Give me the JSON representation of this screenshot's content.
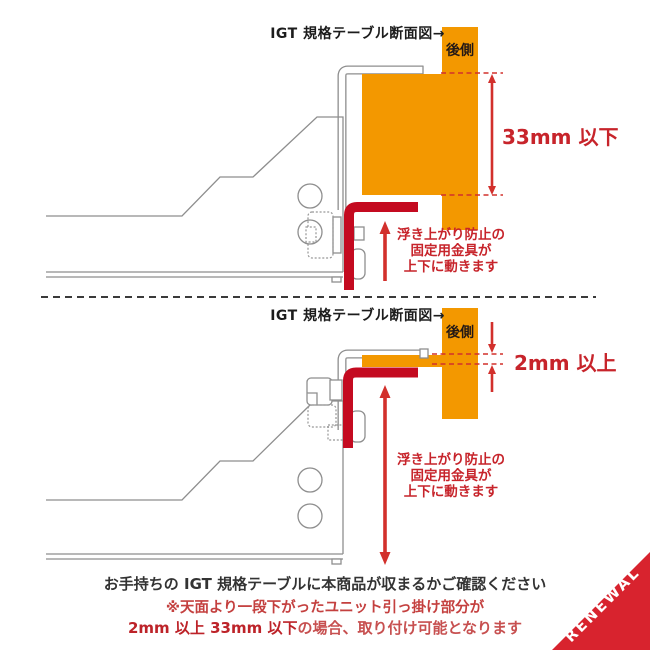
{
  "top_diagram": {
    "label": "IGT 規格テーブル断面図→",
    "rear_label": "後側",
    "dimension": "33mm 以下",
    "note_lines": [
      "浮き上がり防止の",
      "固定用金具が",
      "上下に動きます"
    ]
  },
  "bottom_diagram": {
    "label": "IGT 規格テーブル断面図→",
    "rear_label": "後側",
    "dimension": "2mm 以上",
    "note_lines": [
      "浮き上がり防止の",
      "固定用金具が",
      "上下に動きます"
    ]
  },
  "footer": {
    "line1": "お手持ちの IGT 規格テーブルに本商品が収まるかご確認ください",
    "line2": "※天面より一段下がったユニット引っ掛け部分が",
    "line3_bold": "2mm 以上 33mm 以下",
    "line3_rest": "の場合、取り付け可能となります"
  },
  "banner": {
    "label": "RENEWAL"
  },
  "colors": {
    "orange": "#F39800",
    "red_accent": "#D2302C",
    "red_text": "#C7242B",
    "red_bracket": "#C40A20",
    "banner_red": "#D8232E",
    "line_gray": "#8E8E8E"
  }
}
